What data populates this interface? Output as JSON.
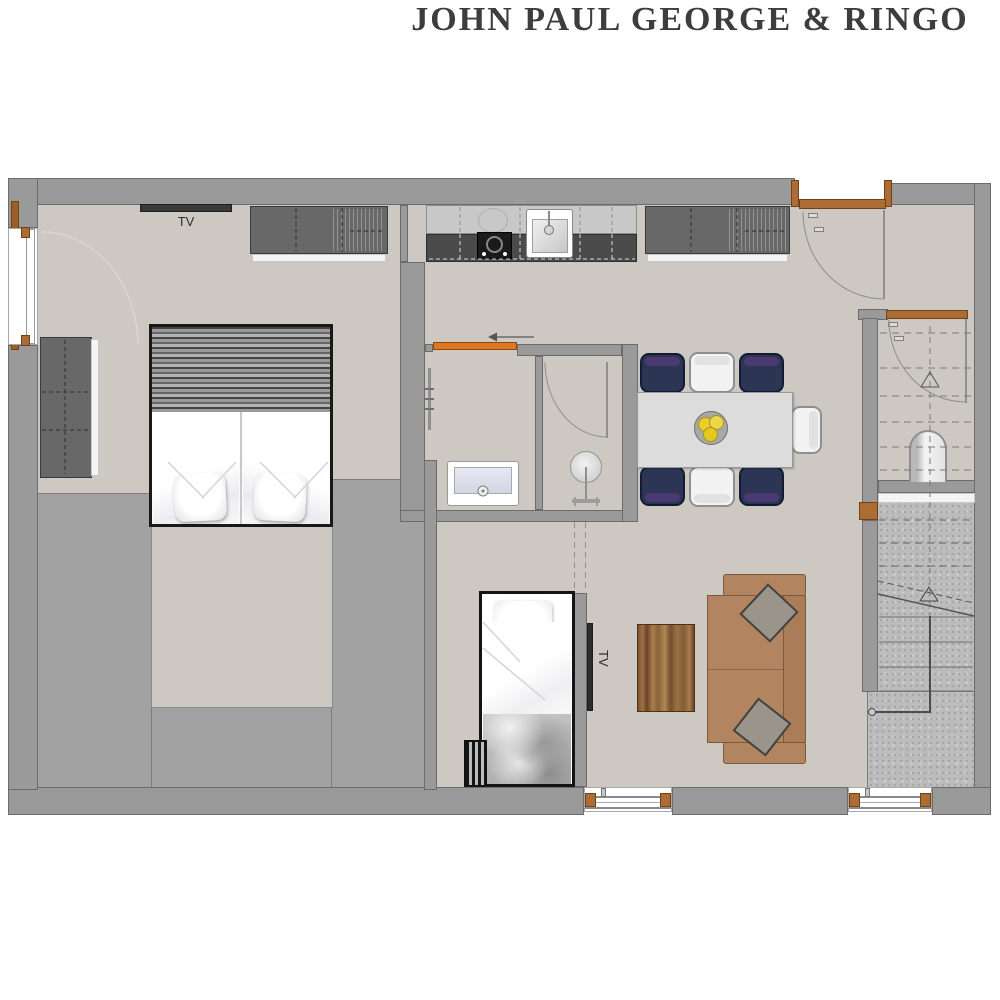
{
  "title": "JOHN PAUL GEORGE & RINGO",
  "labels": {
    "bedroom_tv": "TV",
    "nook_tv": "TV"
  },
  "palette": {
    "wall_gray": "#9a9a9a",
    "floor_beige": "#cdc8c2",
    "low_zone_gray": "#a2a2a2",
    "granite_gray": "#bcbcbc",
    "wood_accent": "#ad6c33",
    "sliding_door_orange": "#e0761f",
    "chair_navy": "#2c3654",
    "chair_band_purple": "#4a3a72",
    "sofa_tan": "#b28460",
    "fruit_yellow": "#e9cf2e",
    "bed_linen_white": "#fbfbfb",
    "counter_dark": "#4b4b4b"
  }
}
